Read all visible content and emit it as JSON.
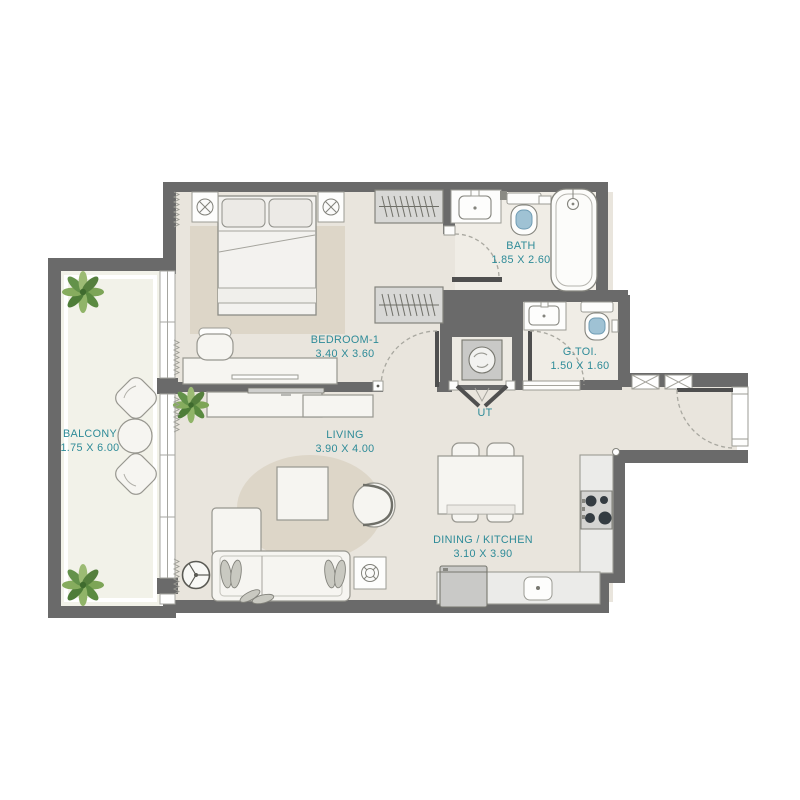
{
  "plan": {
    "title": "apartment-floor-plan",
    "rooms": [
      {
        "name": "BALCONY",
        "dims": "1.75 X 6.00"
      },
      {
        "name": "BEDROOM-1",
        "dims": "3.40 X 3.60"
      },
      {
        "name": "BATH",
        "dims": "1.85 X 2.60"
      },
      {
        "name": "G.TOI.",
        "dims": "1.50 X 1.60"
      },
      {
        "name": "UT",
        "dims": ""
      },
      {
        "name": "LIVING",
        "dims": "3.90 X 4.00"
      },
      {
        "name": "DINING / KITCHEN",
        "dims": "3.10 X 3.90"
      }
    ],
    "colors": {
      "wall": "#6a6a6a",
      "label": "#2e8b98",
      "floor": "#e9e5dd",
      "balcony_floor": "#f2f2e9",
      "bath_floor": "#f0ede6",
      "rug": "#ddd6c8",
      "accent_water": "#9fc2d4"
    }
  }
}
